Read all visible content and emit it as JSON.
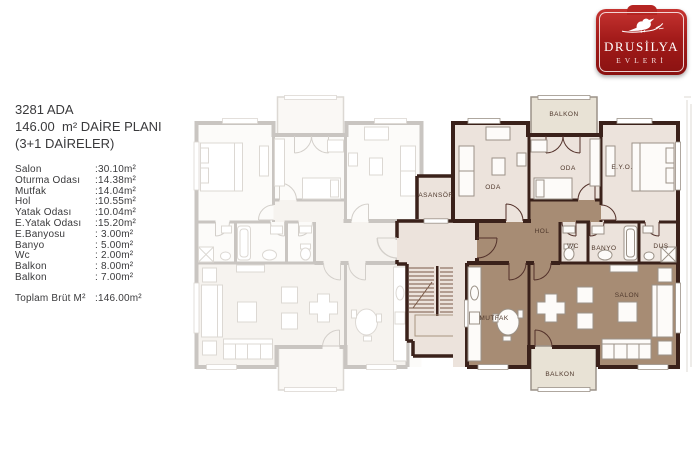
{
  "logo": {
    "name_top": "DRUSİLYA",
    "name_bottom": "EVLERİ"
  },
  "info": {
    "title_line1": "3281 ADA",
    "title_line2": "146.00  m² DAİRE PLANI",
    "title_line3": "(3+1 DAİRELER)",
    "rooms": [
      {
        "label": "Salon",
        "value": ":30.10m²"
      },
      {
        "label": "Oturma Odası",
        "value": ":14.38m²"
      },
      {
        "label": "Mutfak",
        "value": ":14.04m²"
      },
      {
        "label": "Hol",
        "value": ":10.55m²"
      },
      {
        "label": "Yatak Odası",
        "value": ":10.04m²"
      },
      {
        "label": "E.Yatak Odası",
        "value": ":15.20m²"
      },
      {
        "label": "E.Banyosu",
        "value": ": 3.00m²"
      },
      {
        "label": "Banyo",
        "value": ": 5.00m²"
      },
      {
        "label": "Wc",
        "value": ": 2.00m²"
      },
      {
        "label": "Balkon",
        "value": ": 8.00m²"
      },
      {
        "label": "Balkon",
        "value": ": 7.00m²"
      }
    ],
    "total_label": "Toplam Brüt M²",
    "total_value": ":146.00m²"
  },
  "plan": {
    "labels": {
      "balkon_top": "BALKON",
      "oda_left": "ODA",
      "oda_mid": "ODA",
      "eyo": "E.Y.O.",
      "asansor": "ASANSÖR",
      "hol": "HOL",
      "wc": "WC",
      "banyo": "BANYO",
      "dus": "DUŞ",
      "mutfak": "MUTFAK",
      "salon": "SALON",
      "balkon_bottom": "BALKON"
    },
    "colors": {
      "wall_dark": "#3a211a",
      "room_fill": "#ece3dc",
      "highlight_fill": "#a78c74",
      "balcony_fill": "#e8e2d5",
      "wall_light": "#c9c5c1",
      "label_text": "#4f382c",
      "logo_red": "#b02220"
    }
  }
}
